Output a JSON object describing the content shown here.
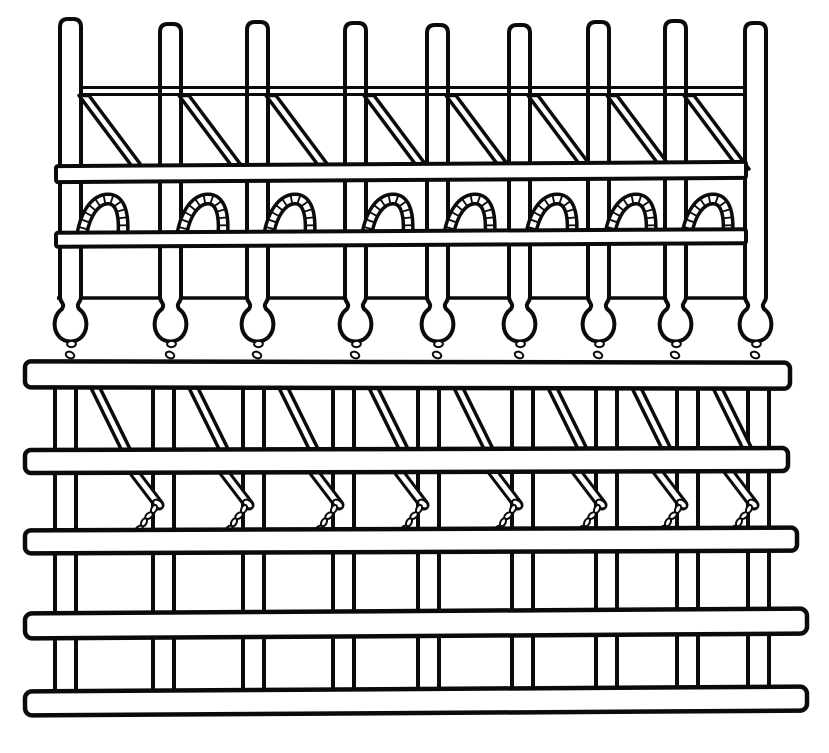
{
  "canvas": {
    "width": 829,
    "height": 753,
    "background": "#ffffff",
    "ink": "#0b0b0b"
  },
  "figure": {
    "kind": "patent-style line drawing of a knitting/loom needle mechanism",
    "needle_count": 9,
    "loop_count": 8,
    "top_diagonal_count": 8,
    "bottom_diagonal_count": 8,
    "chevron_count": 8,
    "lower_rail_count": 5
  },
  "bars": {
    "width": 21,
    "stroke": 4,
    "neck_y": 297,
    "items": [
      {
        "x": 60,
        "top": 19,
        "dxb": -5
      },
      {
        "x": 160,
        "top": 24,
        "dxb": -7
      },
      {
        "x": 247,
        "top": 22,
        "dxb": -4
      },
      {
        "x": 345,
        "top": 23,
        "dxb": -12
      },
      {
        "x": 427,
        "top": 25,
        "dxb": -9
      },
      {
        "x": 509,
        "top": 25,
        "dxb": 3
      },
      {
        "x": 588,
        "top": 22,
        "dxb": 8
      },
      {
        "x": 665,
        "top": 21,
        "dxb": 12
      },
      {
        "x": 745,
        "top": 23,
        "dxb": 3
      }
    ]
  },
  "top_thin_rail": {
    "x1": 80,
    "x2": 746,
    "y_top": 87.5,
    "y_bot": 94.5,
    "lw": 3
  },
  "mid_hairline": {
    "x1": 57,
    "x2": 744,
    "y": 298,
    "lw": 3.5
  },
  "upper_rails": [
    {
      "x": 56,
      "y": 164,
      "w": 690,
      "h": 16,
      "tilt": -0.35,
      "rx": 2
    },
    {
      "x": 56,
      "y": 231,
      "w": 690,
      "h": 14,
      "tilt": -0.3,
      "rx": 2
    }
  ],
  "top_diagonals": {
    "y1": 95.5,
    "y2": 169,
    "dx_from_bar_right": -2,
    "run": 55,
    "strip_w": 10,
    "lw": 3.5
  },
  "loops": {
    "base_y": 229,
    "dx_from_bar_right": 2,
    "tube_black": 13,
    "tube_white": 6,
    "tick_spacing": 7.5,
    "tick_half": 5.2
  },
  "bulbs": {
    "ball_drop": 46,
    "ball_rx": 18.5
  },
  "bulb_chains": {
    "y1": 344,
    "y2": 366,
    "dx": -3,
    "links": 3,
    "link_rx": 3.1,
    "link_ry": 4.4
  },
  "lower_bars": {
    "y": 378,
    "h": 330,
    "stroke": 4
  },
  "lower_diagonals": {
    "y1": 386,
    "y2": 453,
    "dx_from_bar_right": 14,
    "run": 33,
    "strip_w": 9,
    "lw": 3.5
  },
  "chevrons": {
    "top_dx": -23,
    "top_y": 467,
    "elbow_dx": 6,
    "elbow_y": 505,
    "end_dx": -14,
    "end_y": 529,
    "tube_black": 11,
    "tube_white": 5,
    "ring_rx": 5.5,
    "ring_ry": 3.5,
    "ring_rot": 38,
    "links": 4,
    "link_rx": 4.3,
    "link_ry": 2.6
  },
  "lower_rails": [
    {
      "x": 25,
      "y": 362,
      "w": 765,
      "h": 26,
      "tilt": 0.1,
      "rx": 6
    },
    {
      "x": 25,
      "y": 449,
      "w": 763,
      "h": 23,
      "tilt": -0.15,
      "rx": 6
    },
    {
      "x": 25,
      "y": 529,
      "w": 772,
      "h": 23,
      "tilt": -0.2,
      "rx": 6
    },
    {
      "x": 25,
      "y": 611,
      "w": 782,
      "h": 25,
      "tilt": -0.35,
      "rx": 7
    },
    {
      "x": 25,
      "y": 689,
      "w": 782,
      "h": 24,
      "tilt": -0.35,
      "rx": 7
    }
  ]
}
